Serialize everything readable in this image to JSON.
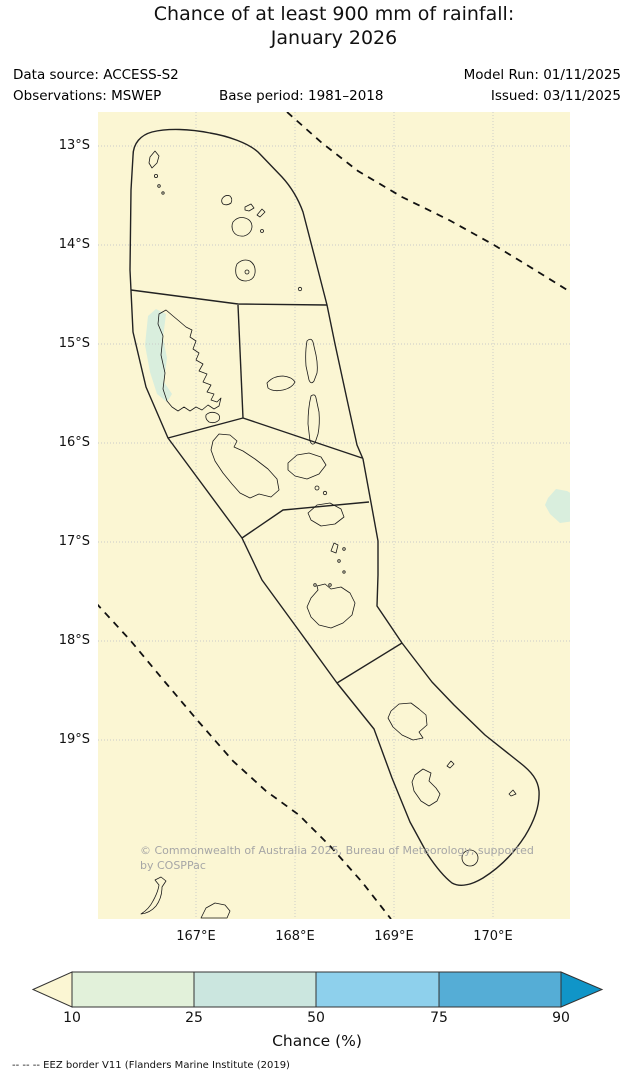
{
  "title": {
    "line1": "Chance of at least 900 mm of rainfall:",
    "line2": "January 2026"
  },
  "header": {
    "data_source": "Data source: ACCESS-S2",
    "observations": "Observations: MSWEP",
    "base_period": "Base period: 1981–2018",
    "model_run": "Model Run: 01/11/2025",
    "issued": "Issued: 03/11/2025"
  },
  "map": {
    "region": "Vanuatu EEZ provincial outlook regions",
    "background_color": "#fbf6d3",
    "shading_low_color": "#d9eedd",
    "lat_ticks": [
      "13°S",
      "14°S",
      "15°S",
      "16°S",
      "17°S",
      "18°S",
      "19°S"
    ],
    "lon_ticks": [
      "167°E",
      "168°E",
      "169°E",
      "170°E"
    ],
    "copyright_line1": "© Commonwealth of Australia 2025, Bureau of Meteorology, supported",
    "copyright_line2": "by COSPPac"
  },
  "legend": {
    "label": "Chance (%)",
    "ticks": [
      "10",
      "25",
      "50",
      "75",
      "90"
    ],
    "segment_colors": [
      "#e2f1da",
      "#cbe6df",
      "#8ed0ec",
      "#55add6"
    ],
    "under_color": "#fbf6d3",
    "over_color": "#1095c8"
  },
  "chart_data": {
    "type": "map",
    "title": "Chance of at least 900 mm of rainfall: January 2026",
    "colorbar_ticks": [
      10,
      25,
      50,
      75,
      90
    ],
    "colorbar_label": "Chance (%)",
    "shaded_regions": "Nearly all of the Vanuatu EEZ shaded below 10% (cream); small 10–25% (pale green) patches west of Espiritu Santo (~15–15.5°S) and at the eastern map edge (~16.8°S)"
  },
  "footnote": "-- -- -- EEZ border V11 (Flanders Marine Institute (2019)"
}
